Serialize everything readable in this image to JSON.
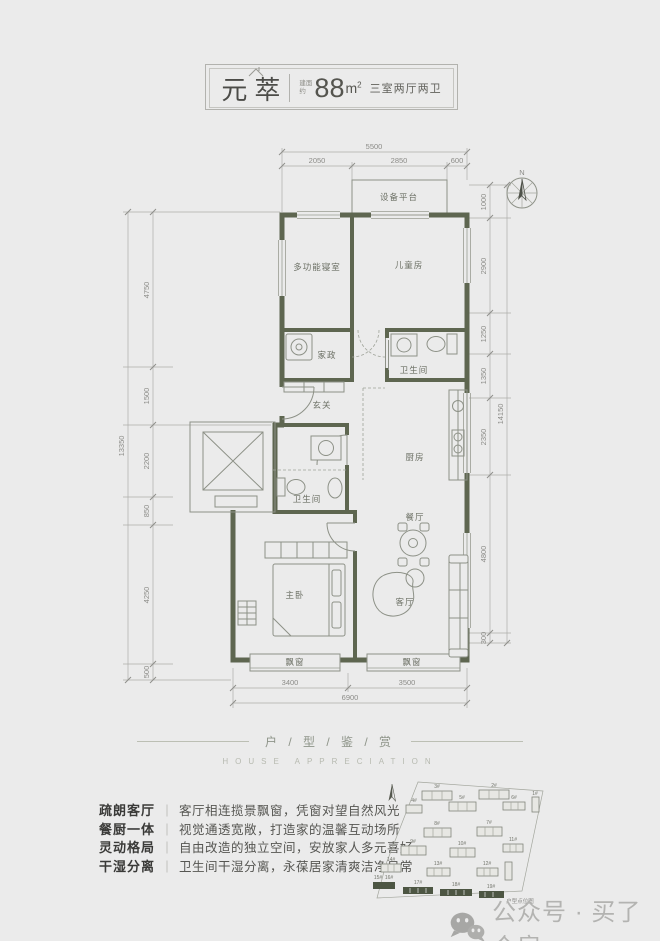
{
  "header": {
    "name": "元萃",
    "area_prefix_1": "建面",
    "area_prefix_2": "约",
    "area_value": "88",
    "area_unit": "m",
    "area_unit_sup": "2",
    "layout": "三室两厅两卫"
  },
  "plan": {
    "compass": "N",
    "rooms": {
      "equipment": "设备平台",
      "multi": "多功能寝室",
      "kids": "儿童房",
      "laundry": "家政",
      "bath_upper": "卫生间",
      "entry": "玄关",
      "bath_lower": "卫生间",
      "kitchen": "厨房",
      "dining": "餐厅",
      "master": "主卧",
      "living": "客厅",
      "bay_left": "飘窗",
      "bay_right": "飘窗"
    },
    "dims": {
      "top_total": "5500",
      "top_segs": [
        "2050",
        "2850",
        "600"
      ],
      "left_total": "13350",
      "left_segs": [
        "4750",
        "1500",
        "2200",
        "850",
        "4250",
        "500"
      ],
      "right_total": "14150",
      "right_segs": [
        "1000",
        "2900",
        "1250",
        "1350",
        "2350",
        "4800",
        "300"
      ],
      "bottom_total": "6900",
      "bottom_segs": [
        "3400",
        "3500"
      ]
    }
  },
  "appreciation": {
    "title": "户 / 型 / 鉴 / 赏",
    "subtitle": "HOUSE APPRECIATION"
  },
  "features_sep": "｜",
  "features": [
    {
      "label": "疏朗客厅",
      "desc": "客厅相连揽景飘窗，凭窗对望自然风光"
    },
    {
      "label": "餐厨一体",
      "desc": "视觉通透宽敞，打造家的温馨互动场所"
    },
    {
      "label": "灵动格局",
      "desc": "自由改造的独立空间，安放家人多元喜好"
    },
    {
      "label": "干湿分离",
      "desc": "卫生间干湿分离，永葆居家清爽洁净日常"
    }
  ],
  "siteplan": {
    "caption": "户型点位图",
    "buildings": [
      "1#",
      "2#",
      "3#",
      "4#",
      "5#",
      "6#",
      "7#",
      "8#",
      "9#",
      "10#",
      "11#",
      "12#",
      "13#",
      "14#",
      "15#",
      "16#",
      "17#",
      "18#",
      "19#"
    ]
  },
  "watermark": {
    "text": "公众号 · 买了个房"
  }
}
